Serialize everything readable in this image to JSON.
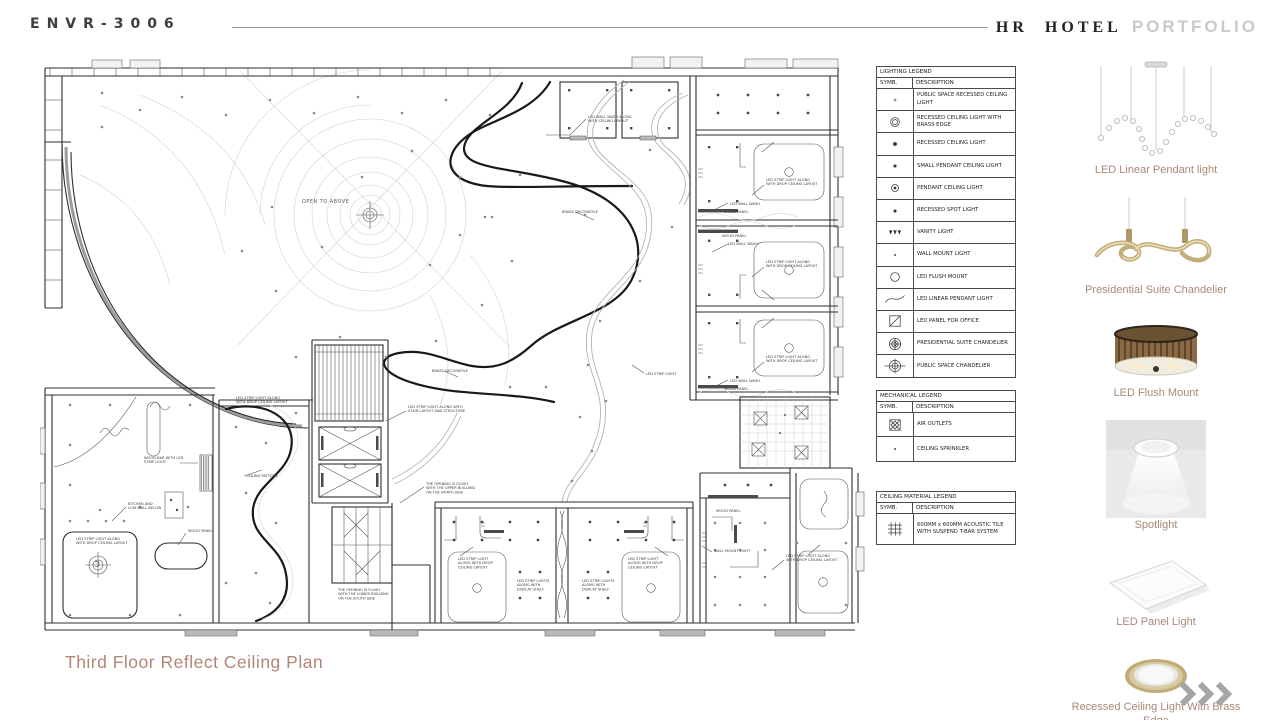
{
  "header": {
    "logo": "ENVR-3006",
    "brand": "HR HOTEL",
    "brand_suffix": "PORTFOLIO"
  },
  "title": "Third Floor Reflect Ceiling Plan",
  "legends": {
    "lighting": {
      "title": "LIGHTING LEGEND",
      "col_symbol": "SYMB.",
      "col_description": "DESCRIPTION",
      "rows": [
        {
          "symbol": "recessed-dot-light",
          "description": "PUBLIC SPACE RECESSED CEILING LIGHT"
        },
        {
          "symbol": "ring",
          "description": "RECESSED CEILING LIGHT WITH BRASS EDGE"
        },
        {
          "symbol": "dot",
          "description": "RECESSED CEILING LIGHT"
        },
        {
          "symbol": "square-dot",
          "description": "SMALL PENDANT CEILING LIGHT"
        },
        {
          "symbol": "circle-dot",
          "description": "PENDANT CEILING LIGHT"
        },
        {
          "symbol": "small-dot",
          "description": "RECESSED SPOT LIGHT"
        },
        {
          "symbol": "vanity",
          "description": "VANITY LIGHT"
        },
        {
          "symbol": "tiny-dot",
          "description": "WALL MOUNT LIGHT"
        },
        {
          "symbol": "circle",
          "description": "LED FLUSH MOUNT"
        },
        {
          "symbol": "s-curve",
          "description": "LED LINEAR PENDANT LIGHT"
        },
        {
          "symbol": "panel",
          "description": "LED PANEL FOR OFFICE"
        },
        {
          "symbol": "chandelier-suite",
          "description": "PRESIDENTIAL SUITE CHANDELIER"
        },
        {
          "symbol": "chandelier-public",
          "description": "PUBLIC SPACE CHANDELIER"
        }
      ]
    },
    "mechanical": {
      "title": "MECHANICAL LEGEND",
      "col_symbol": "SYMB.",
      "col_description": "DESCRIPTION",
      "rows": [
        {
          "symbol": "air-outlet",
          "description": "AIR OUTLETS"
        },
        {
          "symbol": "tiny-dot",
          "description": "CEILING SPRINKLER"
        }
      ]
    },
    "ceiling_material": {
      "title": "CEILING MATERIAL LEGEND",
      "col_symbol": "SYMB.",
      "col_description": "DESCRIPTION",
      "rows": [
        {
          "symbol": "tile-grid",
          "description": "600MM x 600MM ACOUSTIC TILE WITH SUSPEND T-BAR SYSTEM"
        }
      ]
    }
  },
  "products": [
    {
      "label": "LED Linear Pendant light"
    },
    {
      "label": "Presidential Suite Chandelier"
    },
    {
      "label": "LED Flush Mount"
    },
    {
      "label": "Spotlight"
    },
    {
      "label": "LED Panel Light"
    },
    {
      "label": "Recessed Ceiling Light With Brass Edge"
    }
  ],
  "plan": {
    "labels": [
      {
        "t": "OPEN TO ABOVE",
        "x": 262,
        "y": 148,
        "s": "big"
      },
      {
        "t": "LED WALL WASH ALONG\nWITH CEILING LAYOUT",
        "x": 548,
        "y": 63
      },
      {
        "t": "BRASS DECORATIVE",
        "x": 522,
        "y": 158
      },
      {
        "t": "LED STRIP LIGHT ALONG\nWITH DROP CEILING LAYOUT",
        "x": 726,
        "y": 126
      },
      {
        "t": "LED WALL WASH",
        "x": 690,
        "y": 150
      },
      {
        "t": "WOOD PANEL",
        "x": 684,
        "y": 158
      },
      {
        "t": "WOOD PANEL",
        "x": 682,
        "y": 182
      },
      {
        "t": "LED WALL WASH",
        "x": 688,
        "y": 190
      },
      {
        "t": "LED STRIP LIGHT ALONG\nWITH DROP CEILING LAYOUT",
        "x": 726,
        "y": 208
      },
      {
        "t": "LED STRIP LIGHT ALONG\nWITH DROP CEILING LAYOUT",
        "x": 726,
        "y": 303
      },
      {
        "t": "LED WALL WASH",
        "x": 690,
        "y": 327
      },
      {
        "t": "WOOD PANEL",
        "x": 684,
        "y": 335
      },
      {
        "t": "BRASS DECORATIVE",
        "x": 392,
        "y": 317
      },
      {
        "t": "LED STRIP LIGHT",
        "x": 606,
        "y": 320
      },
      {
        "t": "LED STRIP LIGHT ALONG\nWITH DROP CEILING LAYOUT",
        "x": 196,
        "y": 344
      },
      {
        "t": "LED STRIP LIGHT ALONG WITH\nSTAIR LAYOUT AND STRUCTURE",
        "x": 368,
        "y": 353
      },
      {
        "t": "THE OPENING IS FLUSH\nWITH THE UPPER BUILDING\nON THE NORTH SIDE",
        "x": 386,
        "y": 430
      },
      {
        "t": "CEILING PATTERN",
        "x": 206,
        "y": 422
      },
      {
        "t": "WOOD BAR WITH LED\nSTRIP LIGHT",
        "x": 104,
        "y": 404
      },
      {
        "t": "KITCHEN AND\nLOW WALL BELOW",
        "x": 88,
        "y": 450
      },
      {
        "t": "WOOD PANEL",
        "x": 148,
        "y": 477
      },
      {
        "t": "LED STRIP LIGHT ALONG\nWITH DROP CEILING LAYOUT",
        "x": 36,
        "y": 485
      },
      {
        "t": "THE OPENING IS FLUSH\nWITH THE LOWER BUILDING\nON THE SOUTH SIDE",
        "x": 298,
        "y": 536
      },
      {
        "t": "LED STRIP LIGHT\nALONG WITH DROP\nCEILING LAYOUT",
        "x": 418,
        "y": 505
      },
      {
        "t": "LED STRIP LIGHTS\nALONG WITH\nDISPLAY SHELF",
        "x": 477,
        "y": 527
      },
      {
        "t": "LED STRIP LIGHTS\nALONG WITH\nDISPLAY SHELF",
        "x": 542,
        "y": 527
      },
      {
        "t": "LED STRIP LIGHT\nALONG WITH DROP\nCEILING LAYOUT",
        "x": 588,
        "y": 505
      },
      {
        "t": "WOOD PANEL",
        "x": 676,
        "y": 457
      },
      {
        "t": "WALL MOUNT LIGHT",
        "x": 674,
        "y": 497
      },
      {
        "t": "LED STRIP LIGHT ALONG\nWITH DROP CEILING LAYOUT",
        "x": 746,
        "y": 502
      }
    ]
  }
}
